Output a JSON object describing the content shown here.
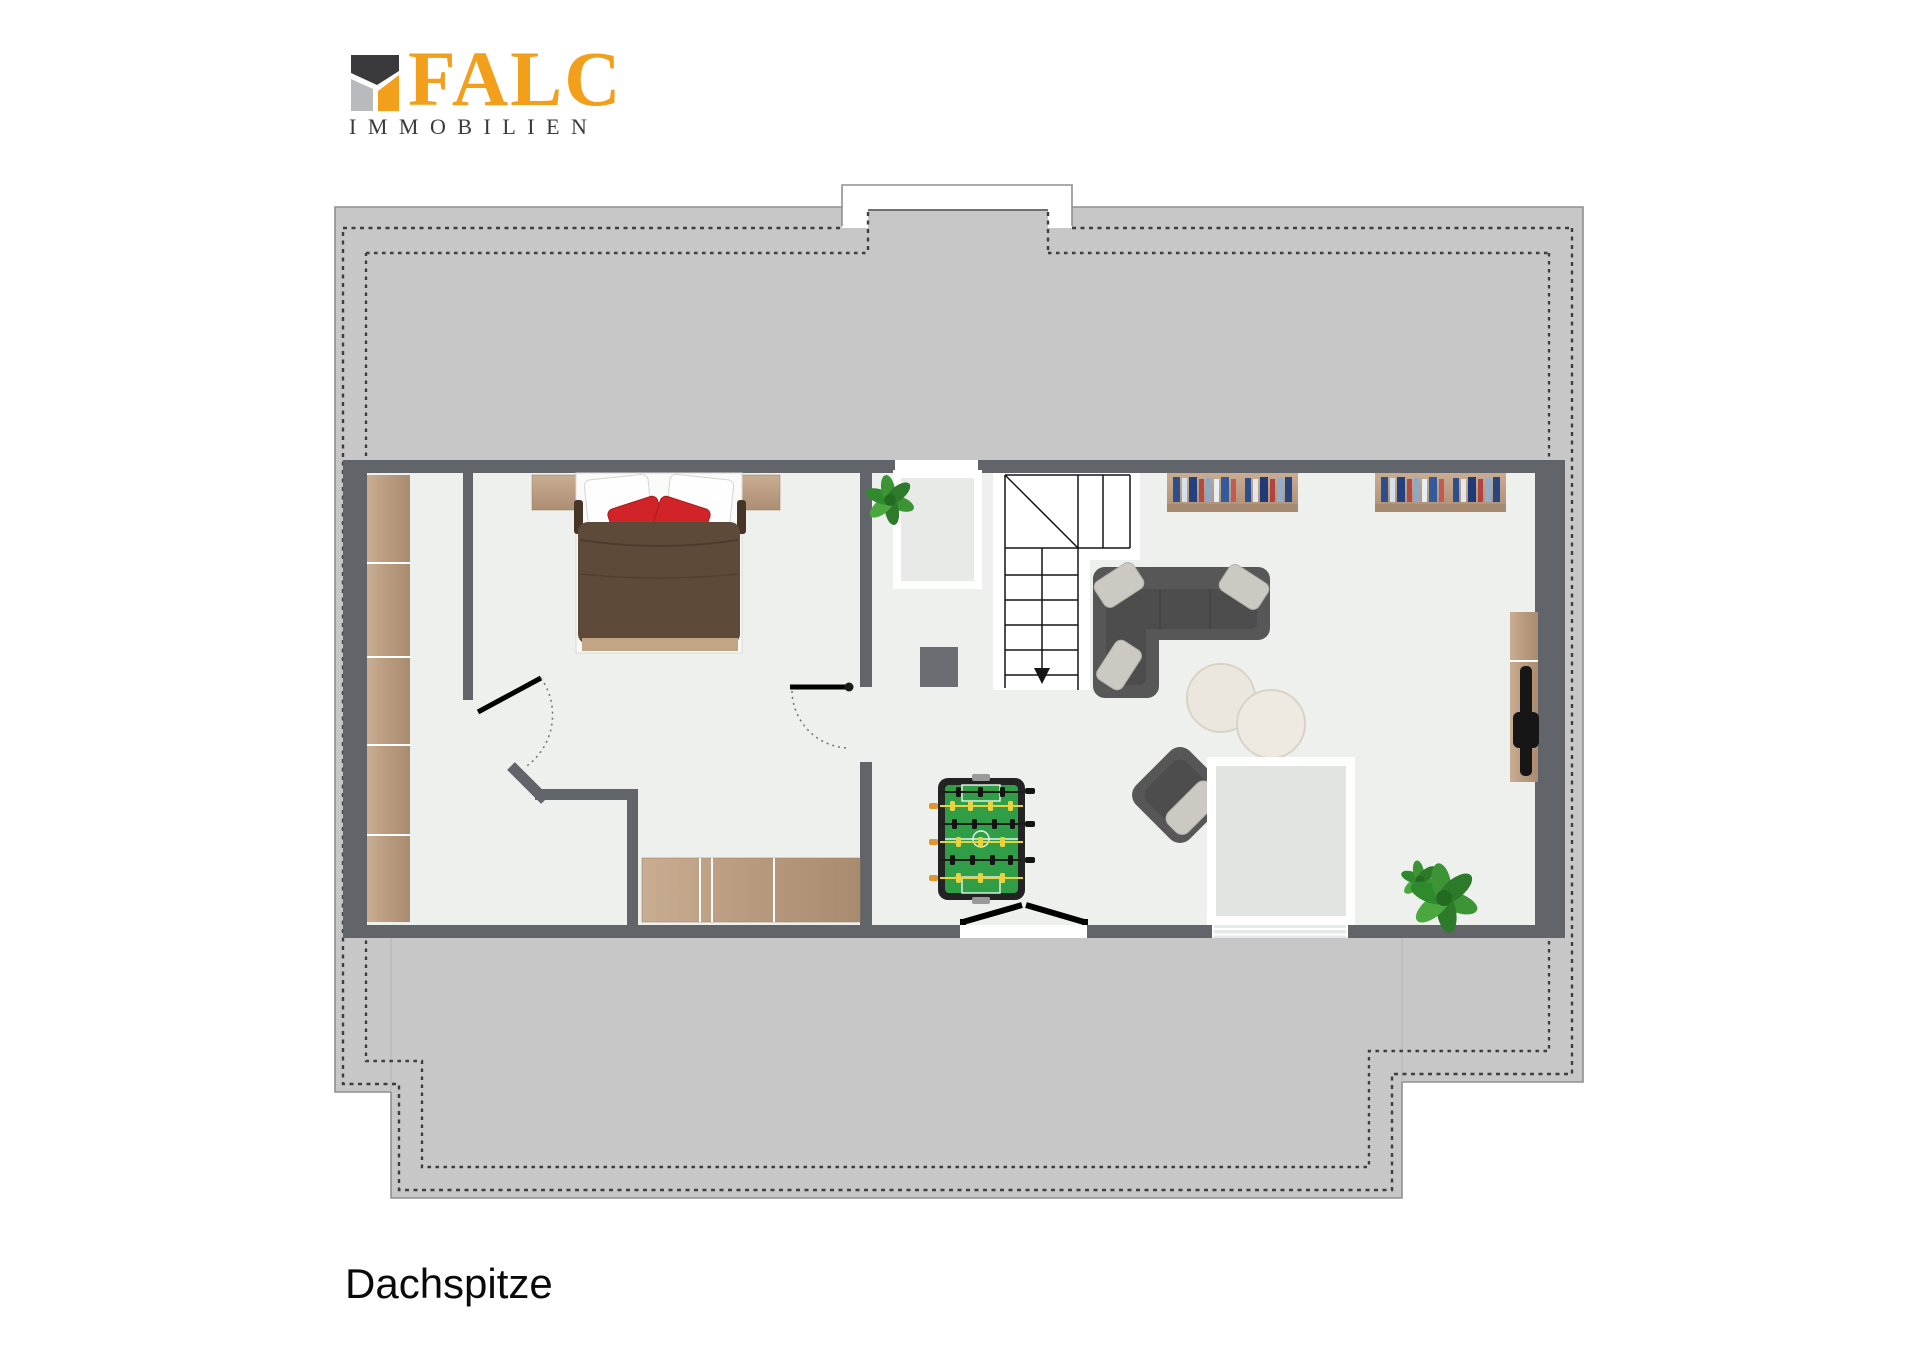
{
  "brand": {
    "name": "FALC",
    "subtitle": "IMMOBILIEN"
  },
  "floor": {
    "label": "Dachspitze"
  },
  "colors": {
    "brand_orange": "#F2A01C",
    "logo_dark": "#3A3A3C",
    "logo_gray": "#B9BABD",
    "roof_gray": "#C6C7C6",
    "wall_gray": "#616468",
    "floor_light": "#EEF0ED",
    "outline_gray": "#8F8F8F",
    "dash_dark": "#3E3E3E",
    "wood_light": "#CBB296",
    "wood_dark": "#A98B70",
    "sofa_gray": "#575757",
    "cushion_light": "#CCC9C3",
    "duvet_brown": "#5E4A39",
    "pillow_red": "#D02428",
    "cream": "#ECE7DE",
    "foosball_green": "#2F9E47",
    "foosball_frame": "#232323",
    "player_yellow": "#E8D23E",
    "handle_orange": "#E0962E",
    "plant_green": "#3C9436"
  }
}
